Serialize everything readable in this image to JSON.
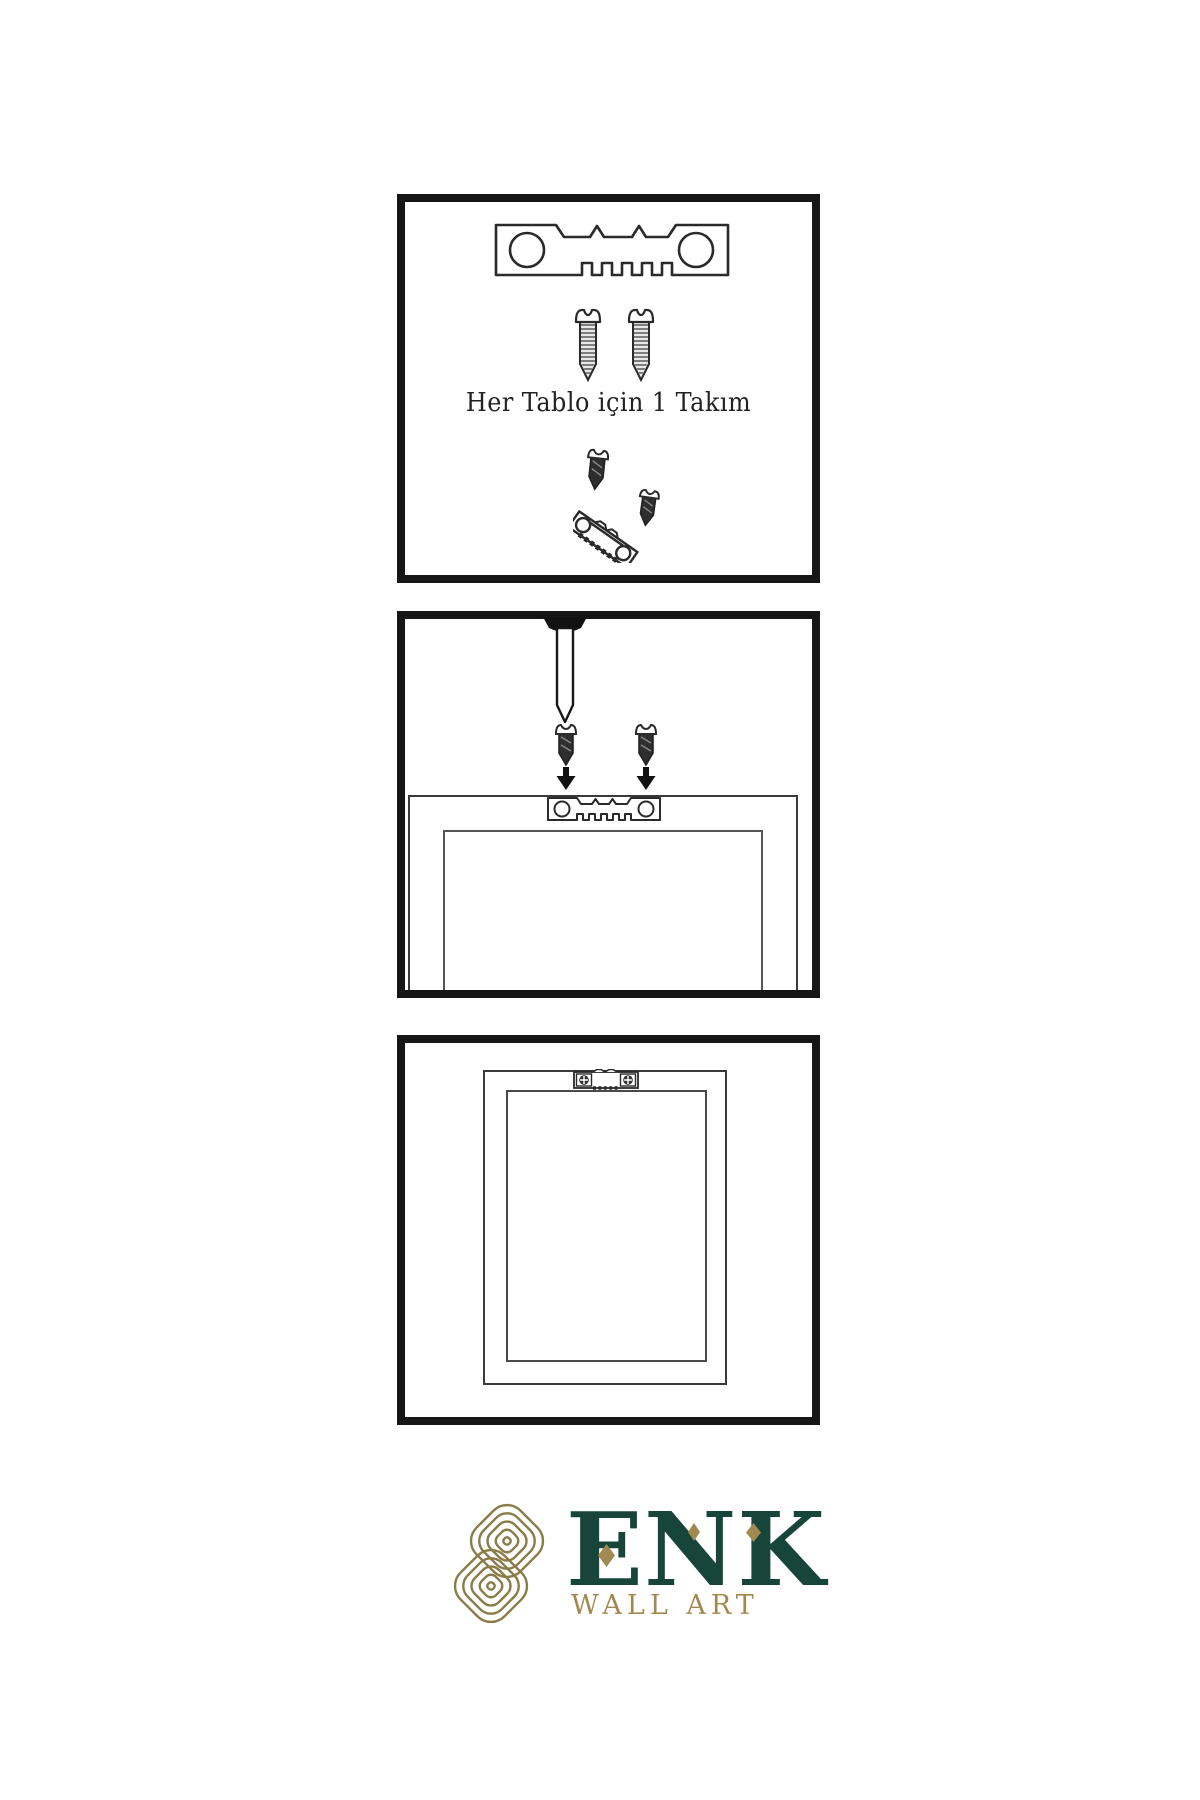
{
  "panels": {
    "kit": {
      "caption": "Her Tablo için 1 Takım",
      "items": [
        "sawtooth-hanger",
        "screw-left",
        "screw-right",
        "screw-into-angled-hanger"
      ]
    },
    "mounting": {
      "items": [
        "wall-nail",
        "screw-down-left",
        "screw-down-right",
        "arrow-down-left",
        "arrow-down-right",
        "frame-back",
        "canvas-back",
        "sawtooth-hanger-mounted"
      ]
    },
    "hung": {
      "items": [
        "hung-frame",
        "hung-canvas",
        "sawtooth-hanger-with-screws"
      ]
    }
  },
  "brand": {
    "name": "ENK",
    "tagline": "WALL ART"
  },
  "colors": {
    "line": "#2a2a2a",
    "panel_border": "#161616",
    "brand_green": "#17453a",
    "brand_gold": "#a18a52",
    "emblem_gold": "#8a7c49"
  }
}
